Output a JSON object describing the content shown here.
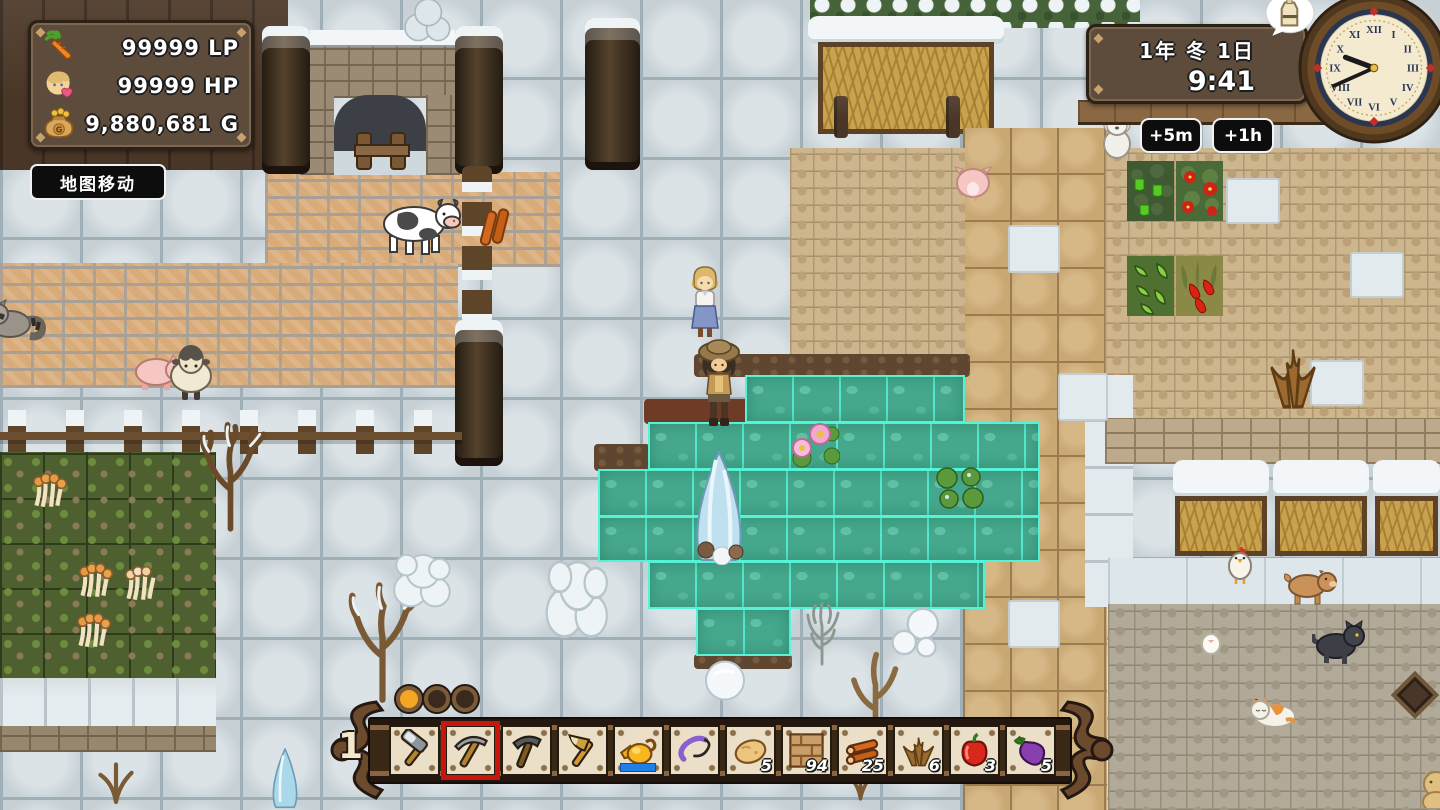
{
  "hud": {
    "stats_panel": {
      "rows": [
        {
          "icon": "carrot-icon",
          "value": "99999",
          "unit": "LP"
        },
        {
          "icon": "portrait-icon",
          "value": "99999",
          "unit": "HP"
        },
        {
          "icon": "money-bag-icon",
          "value": "9,880,681",
          "unit": "G"
        }
      ]
    },
    "map_move_badge": "地图移动",
    "datetime_panel": {
      "date": "1年 冬 1日",
      "time": "9:41"
    },
    "time_buttons": [
      {
        "label": "+5m"
      },
      {
        "label": "+1h"
      }
    ],
    "clock": {
      "numerals": [
        "XII",
        "I",
        "II",
        "III",
        "IV",
        "V",
        "VI",
        "VII",
        "VIII",
        "IX",
        "X",
        "XI"
      ],
      "hour": 9,
      "minute": 41
    },
    "status_bubble": {
      "icon": "milk-jug-icon"
    }
  },
  "hotbar": {
    "page_number": "1",
    "dots": [
      {
        "state": "active"
      },
      {
        "state": "inactive"
      },
      {
        "state": "inactive"
      }
    ],
    "slots": [
      {
        "name": "hammer",
        "icon": "hammer-icon",
        "selected": false
      },
      {
        "name": "pickaxe",
        "icon": "pickaxe-icon",
        "selected": true
      },
      {
        "name": "sickle",
        "icon": "sickle-icon",
        "selected": false
      },
      {
        "name": "axe",
        "icon": "axe-icon",
        "selected": false
      },
      {
        "name": "watering-can",
        "icon": "watering-can-icon",
        "selected": false,
        "gauge": true
      },
      {
        "name": "whip",
        "icon": "whip-icon",
        "selected": false
      },
      {
        "name": "potato",
        "icon": "potato-icon",
        "count": "5"
      },
      {
        "name": "brick-floor",
        "icon": "brick-floor-icon",
        "count": "94"
      },
      {
        "name": "logs",
        "icon": "logs-icon",
        "count": "25"
      },
      {
        "name": "dried-grass",
        "icon": "dried-grass-icon",
        "count": "6"
      },
      {
        "name": "bell-pepper",
        "icon": "bell-pepper-icon",
        "count": "3"
      },
      {
        "name": "eggplant",
        "icon": "eggplant-icon",
        "count": "5"
      }
    ]
  },
  "world": {
    "season": "winter",
    "entities": [
      "cow",
      "sheep",
      "pig",
      "pig-rear",
      "raccoon",
      "white-dog",
      "chicken",
      "chick",
      "brown-dog",
      "black-cat",
      "calico-cat",
      "tan-cat",
      "player-character",
      "npc-girl"
    ],
    "highlighted_area": "pond-water-tiles"
  },
  "colors": {
    "selection_red": "#c8150d",
    "water_highlight": "#56f5d8",
    "gauge_blue": "#1e7fe8",
    "panel_brown": "#5d4b3b"
  }
}
